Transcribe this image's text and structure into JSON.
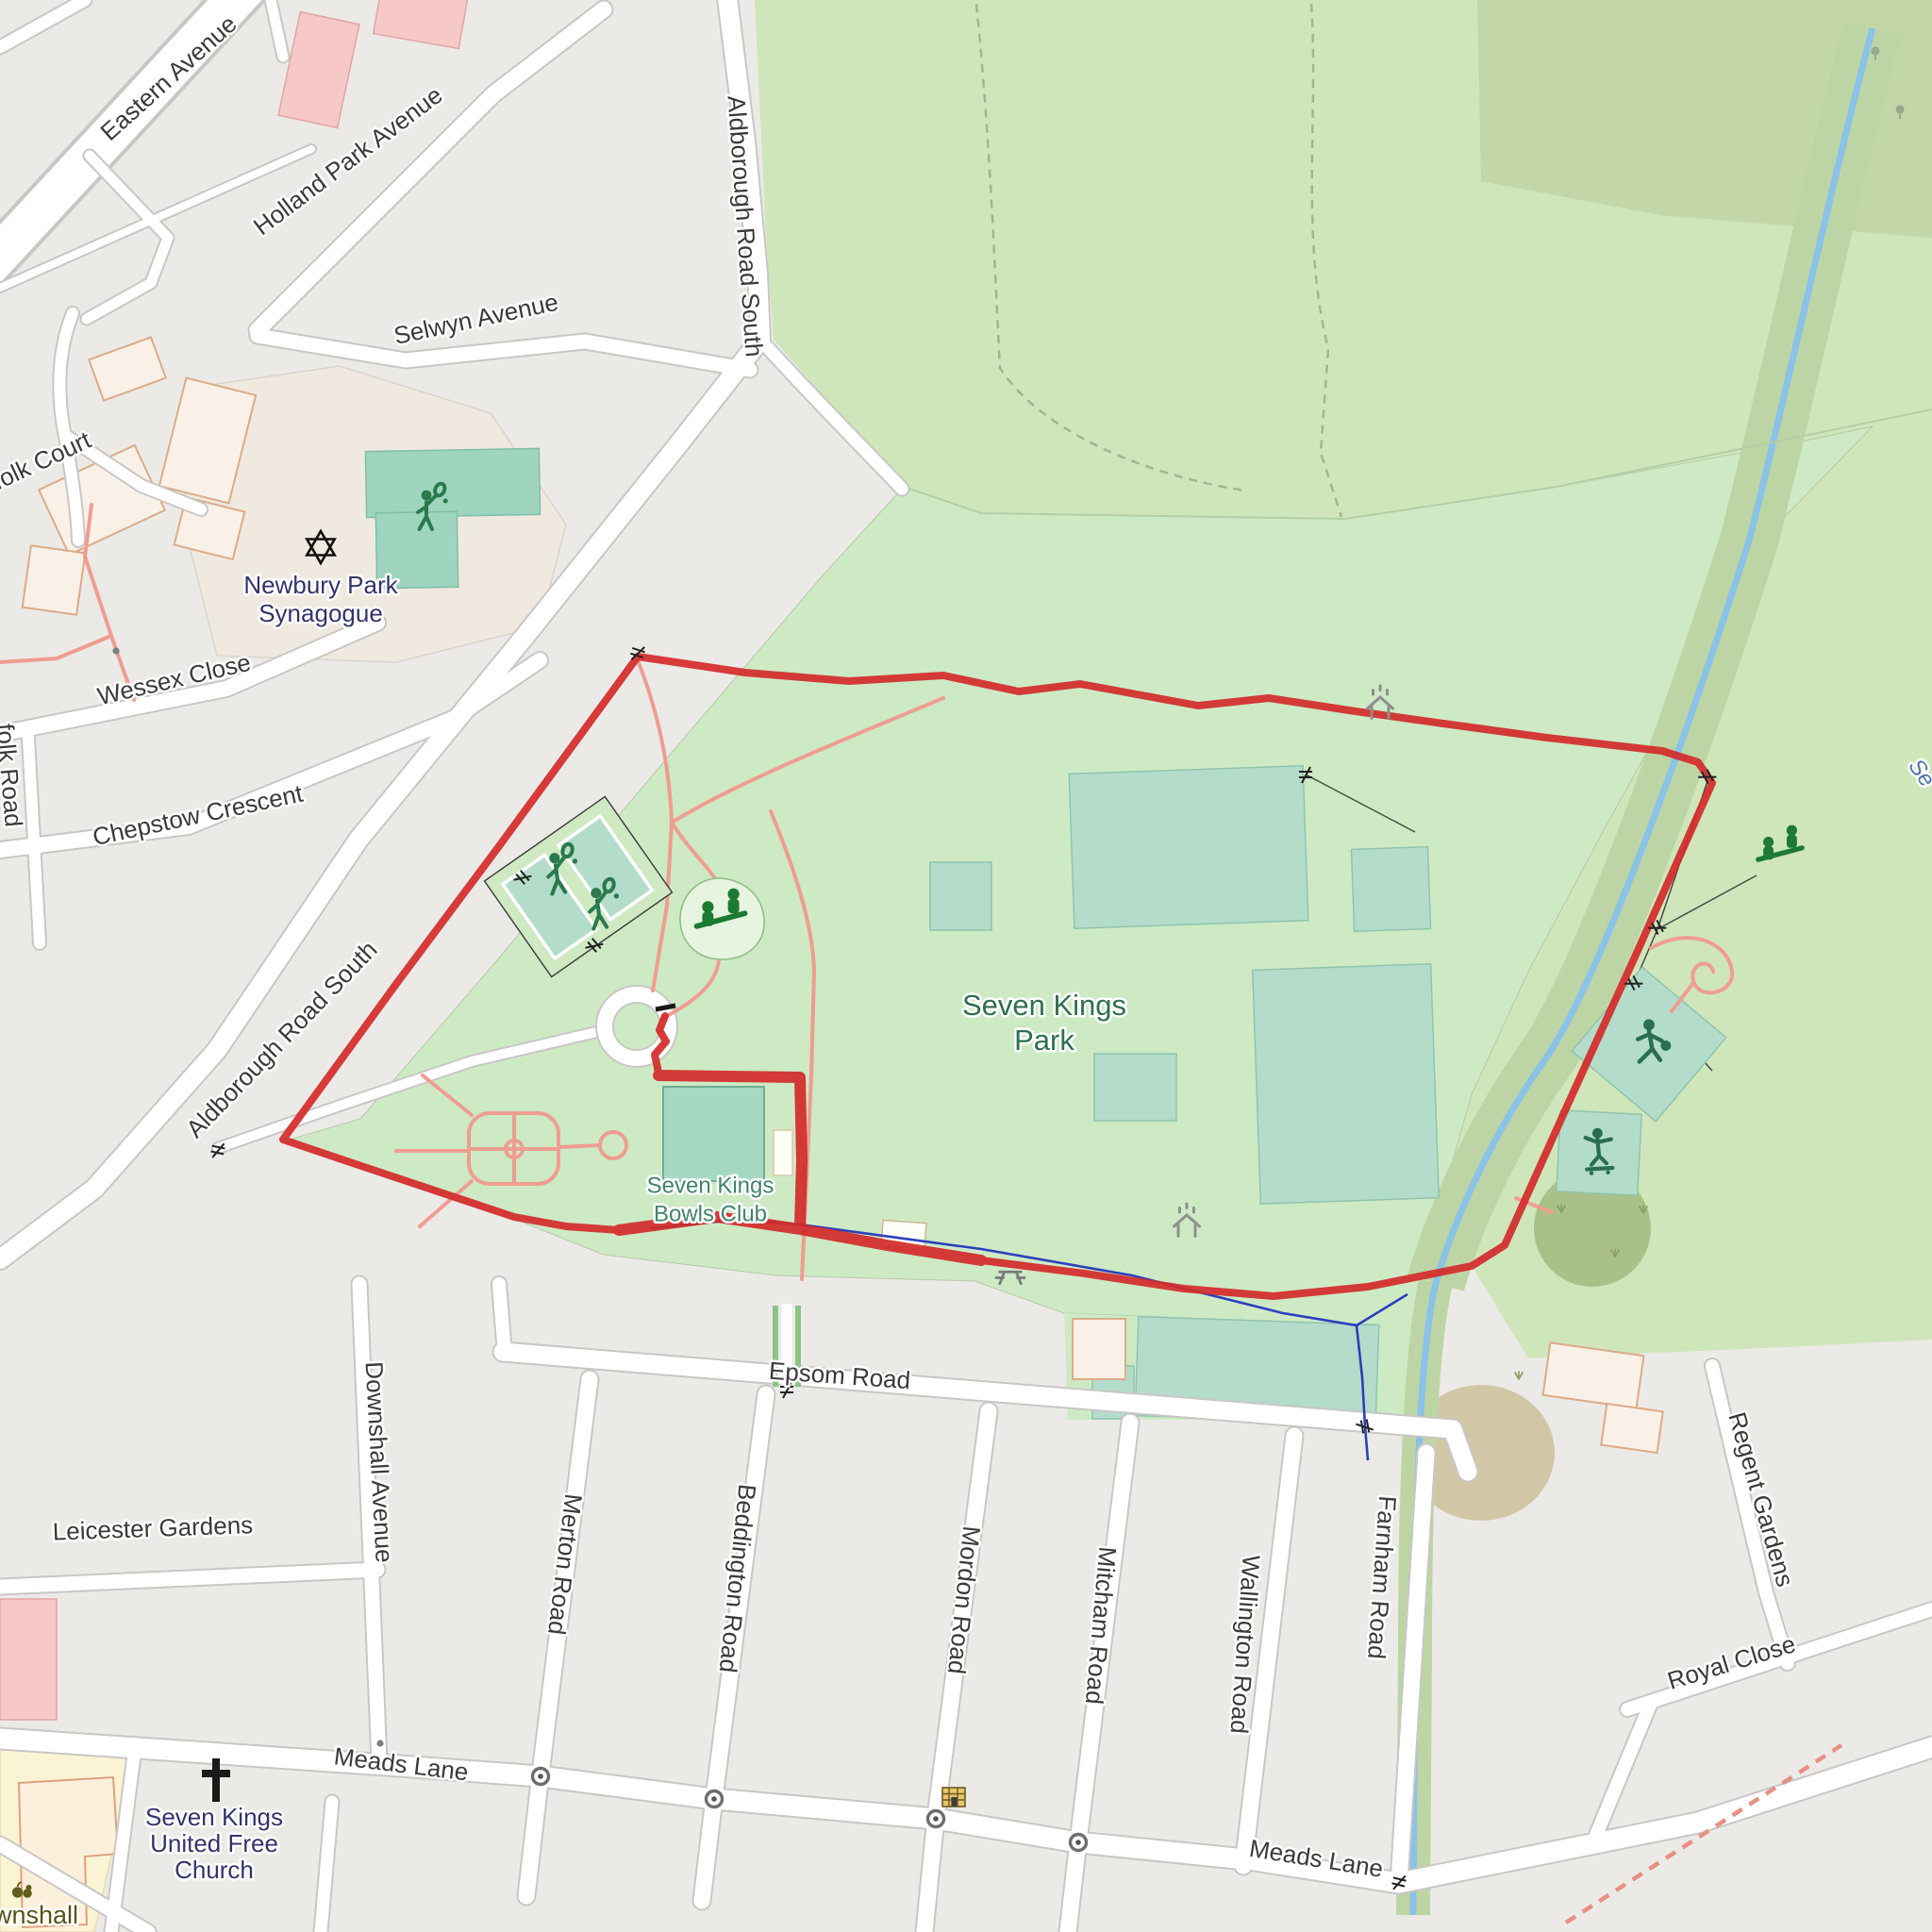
{
  "map": {
    "streets": {
      "eastern_avenue": "Eastern Avenue",
      "holland_park_avenue": "Holland Park Avenue",
      "selwyn_avenue": "Selwyn Avenue",
      "aldborough_road_south_north": "Aldborough Road South",
      "aldborough_road_south_west": "Aldborough Road South",
      "norfolk_court_partial": "folk Court",
      "wessex_close": "Wessex Close",
      "suffolk_road_partial": "folk Road",
      "chepstow_crescent": "Chepstow Crescent",
      "epsom_road": "Epsom Road",
      "leicester_gardens": "Leicester Gardens",
      "downshall_avenue": "Downshall Avenue",
      "merton_road": "Merton Road",
      "beddington_road": "Beddington Road",
      "mordon_road": "Mordon Road",
      "mitcham_road": "Mitcham Road",
      "wallington_road": "Wallington Road",
      "farnham_road": "Farnham Road",
      "regent_gardens": "Regent Gardens",
      "royal_close": "Royal Close",
      "meads_lane_west": "Meads Lane",
      "meads_lane_east": "Meads Lane"
    },
    "places": {
      "park_line1": "Seven Kings",
      "park_line2": "Park",
      "bowls_line1": "Seven Kings",
      "bowls_line2": "Bowls Club",
      "synagogue_line1": "Newbury Park",
      "synagogue_line2": "Synagogue",
      "church_line1": "Seven Kings",
      "church_line2": "United Free",
      "church_line3": "Church",
      "school_partial": "wnshall",
      "stream_partial": "Se"
    },
    "colors": {
      "route_red": "#d42a2a",
      "trunk_orange": "#ee9c7c",
      "park_green": "#cdeac5",
      "grass_green": "#cfe6bb",
      "scrub_olive": "#c2d6a7",
      "pitch_teal": "#b4dcca",
      "water_blue": "#8ac2e8",
      "drain_blue": "#2c3fbe",
      "path_pink": "#ef9d91",
      "road_casing": "#c9c7c5",
      "poi_navy": "#33336b",
      "park_label_green": "#2f6e4f"
    }
  }
}
